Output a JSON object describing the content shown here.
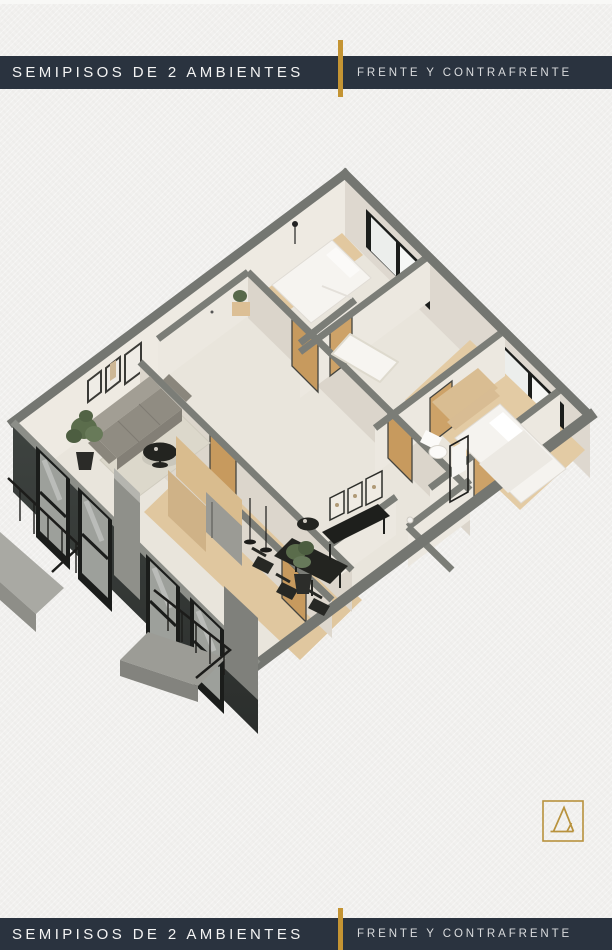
{
  "banners": {
    "title": "SEMIPISOS DE 2 AMBIENTES",
    "subtitle": "FRENTE Y CONTRAFRENTE",
    "background_color": "#2a333f",
    "accent_gold": "#c49433"
  },
  "floor_plan": {
    "type": "isometric-3d-cutaway-render",
    "description": "Two semi-floor 2-room apartments (front and back units) with living room, kitchen, dining, bedrooms, bathrooms, balconies",
    "palette": {
      "wall_cap_gray": "#7b7d77",
      "wall_cream": "#e9e5dc",
      "wood_floor": "#e0c79f",
      "dark_facade": "#383b39",
      "window_frame_black": "#1b1d1b"
    }
  },
  "logo": {
    "monogram": "A",
    "color": "#b8923d"
  }
}
